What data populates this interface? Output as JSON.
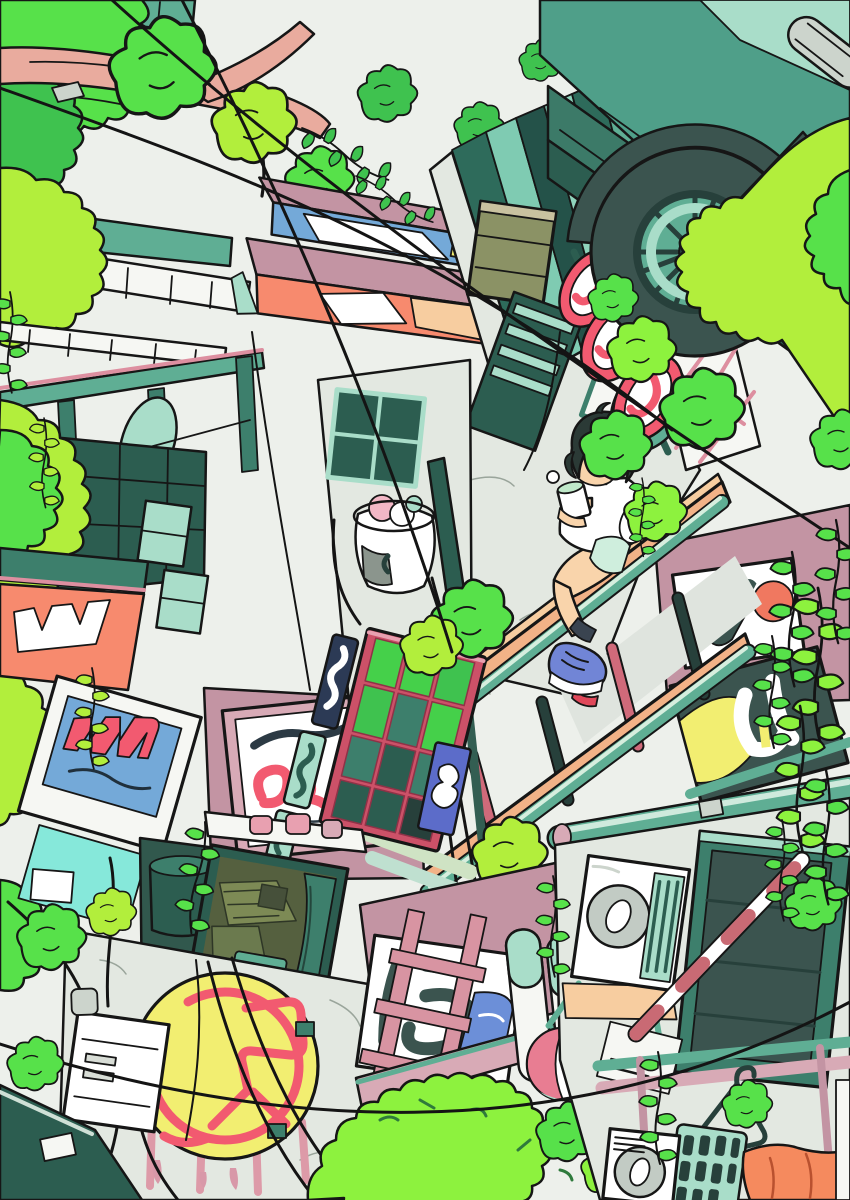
{
  "scene": {
    "description": "Anime-style illustration looking straight up a narrow overgrown alley: a short-haired girl holding a mint drink sits on an orange beam walkway; around her are vine-covered buildings, a red telephone booth, stacked round red-rim shop signs, a motorbike wheel overhanging a ledge, billboards with stylized illegible lettering, a yellow circular neon sign, air-conditioner units, pipes, railings and criss-crossing power lines under a pale sky.",
    "objects": [
      {
        "name": "girl",
        "detail": "dark bob hair, white tee, mint shorts, blue sneakers, holding cup with mint drink"
      },
      {
        "name": "phone-booth",
        "detail": "crimson frame, green glass panels, illegible vertical signboards"
      },
      {
        "name": "motorcycle-wheel",
        "detail": "dark tire with spokes and mint rim on an overhead ledge"
      },
      {
        "name": "round-signs",
        "detail": "three stacked circular signs with red rims and white faces"
      },
      {
        "name": "neon-circle-sign",
        "detail": "yellow disc with red neon glyph on grey wall"
      },
      {
        "name": "boutique-sign",
        "detail": "white board, blue panel, pink script letters"
      },
      {
        "name": "script-sign",
        "detail": "white board with red cursive lettering in pink frame"
      },
      {
        "name": "graffiti-sign-white",
        "detail": "white board, dark glyphs, red-orange dot"
      },
      {
        "name": "graffiti-sign-dark",
        "detail": "dark slate board, yellow patch, white glyphs"
      },
      {
        "name": "room-window",
        "detail": "open window showing olive room interior with teal curtain"
      },
      {
        "name": "ac-unit",
        "detail": "white outdoor unit with round fan and mint grille"
      },
      {
        "name": "electric-box",
        "detail": "white meter box with black cables"
      },
      {
        "name": "walkway-beams",
        "detail": "orange beams with teal pipes and pink rungs"
      },
      {
        "name": "tree-branch",
        "detail": "pink bare branch entering from top left"
      },
      {
        "name": "power-lines",
        "detail": "black wires crossing the sky"
      },
      {
        "name": "vines",
        "detail": "bright green ivy and hanging leaf chains everywhere"
      }
    ]
  },
  "palette": {
    "ink": "#161616",
    "sky": "#edf0eb",
    "paper": "#f6f7f3",
    "white": "#ffffff",
    "grayWall": "#e3e8e1",
    "grayLight": "#ccd4cc",
    "fanGray": "#c2cbc4",
    "tealA": "#a9ddc9",
    "tealB": "#5fae94",
    "tealC": "#3d7f6c",
    "tealD": "#2c5d50",
    "slate": "#3b544f",
    "slateDeep": "#27403b",
    "greenBright": "#57e14a",
    "greenYellow": "#b2ee3c",
    "greenMid": "#3fc24f",
    "greenNeon": "#8df23e",
    "olive": "#8b9265",
    "oliveDark": "#5d6b42",
    "oliveDesk": "#7d8a55",
    "branch": "#e9ab9e",
    "mauve": "#c394a3",
    "mauveLight": "#d8aab6",
    "crimson": "#cc5168",
    "red": "#f25a70",
    "salmon": "#f78a6e",
    "orangeBeam": "#f2b287",
    "peach": "#f7cda0",
    "yellow": "#f2ee71",
    "blue": "#5c6cc9",
    "blueLight": "#74a9d8",
    "sneaker": "#7185d6",
    "skin": "#f9d4ab",
    "hair": "#2b3a36",
    "cyan": "#86e8da",
    "pinkFrame": "#dd8fa0",
    "drink": "#bfe9c9",
    "glassGreen": "#45d04a",
    "sock": "#3a4450",
    "redShoe": "#e0485a"
  }
}
